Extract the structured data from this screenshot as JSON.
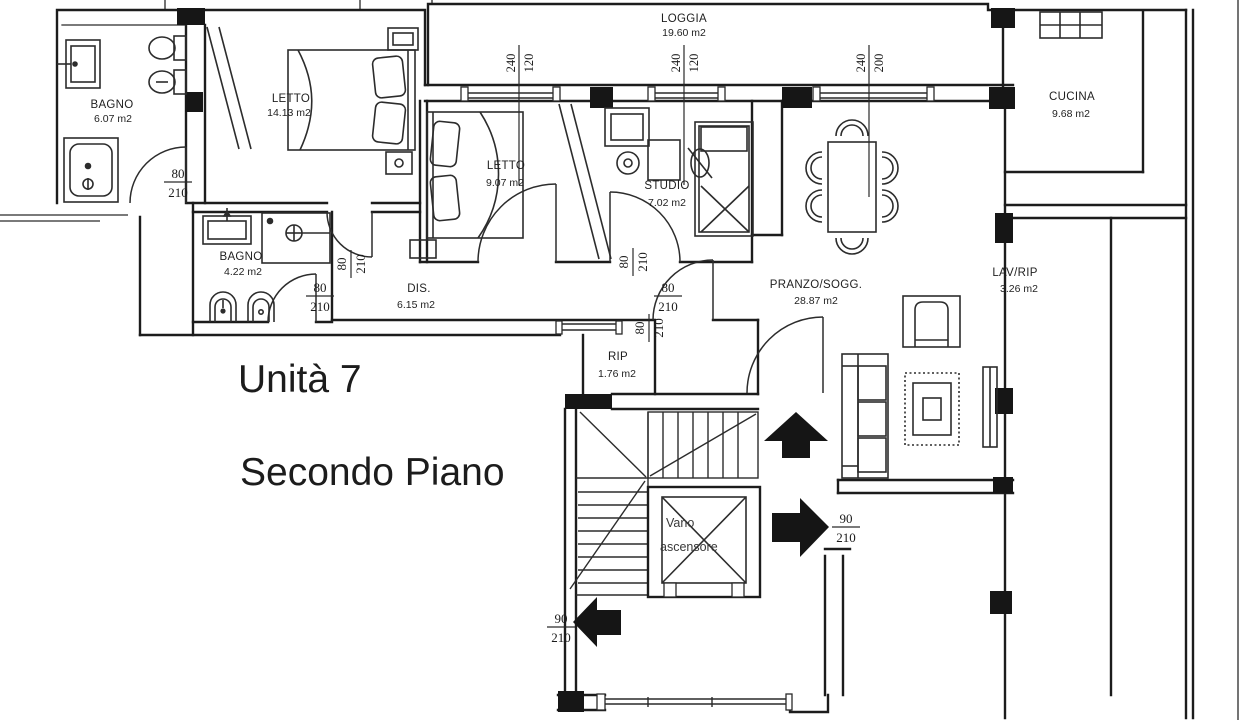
{
  "plan": {
    "title": "Unità 7",
    "subtitle": "Secondo Piano",
    "rooms": {
      "loggia": {
        "name": "LOGGIA",
        "area": "19.60 m2"
      },
      "bagno_grande": {
        "name": "BAGNO",
        "area": "6.07 m2"
      },
      "letto_grande": {
        "name": "LETTO",
        "area": "14.13 m2"
      },
      "letto_piccolo": {
        "name": "LETTO",
        "area": "9.07 m2"
      },
      "studio": {
        "name": "STUDIO",
        "area": "7.02 m2"
      },
      "cucina": {
        "name": "CUCINA",
        "area": "9.68 m2"
      },
      "bagno_piccolo": {
        "name": "BAGNO",
        "area": "4.22 m2"
      },
      "disimpegno": {
        "name": "DIS.",
        "area": "6.15 m2"
      },
      "pranzo": {
        "name": "PRANZO/SOGG.",
        "area": "28.87 m2"
      },
      "lav_rip": {
        "name": "LAV/RIP",
        "area": "3.26 m2"
      },
      "rip": {
        "name": "RIP",
        "area": "1.76 m2"
      },
      "vano_ascensore": {
        "line1": "Vano",
        "line2": "ascensore"
      }
    },
    "dimensions": {
      "door_interior": {
        "w": "80",
        "h": "210"
      },
      "door_entry": {
        "w": "90",
        "h": "210"
      },
      "window_small": {
        "w": "120",
        "h": "240"
      },
      "window_large": {
        "w": "200",
        "h": "240"
      }
    }
  }
}
